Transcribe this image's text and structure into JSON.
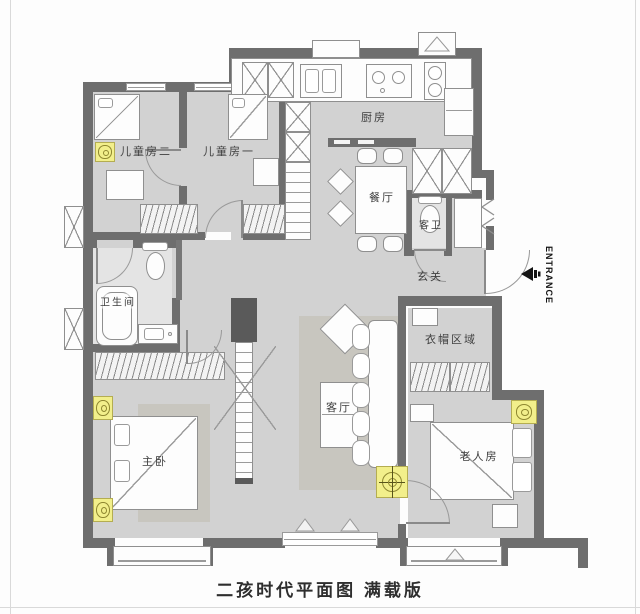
{
  "title": "二孩时代平面图 满载版",
  "entrance": {
    "label": "ENTRANCE"
  },
  "rooms": {
    "kids_room_2": {
      "label": "儿童房二"
    },
    "kids_room_1": {
      "label": "儿童房一"
    },
    "kitchen": {
      "label": "厨房"
    },
    "dining_room": {
      "label": "餐厅"
    },
    "guest_bathroom": {
      "label": "客卫"
    },
    "entry_hall": {
      "label": "玄关"
    },
    "bathroom": {
      "label": "卫生间"
    },
    "living_room": {
      "label": "客厅"
    },
    "cloakroom": {
      "label": "衣帽区域"
    },
    "master_bedroom": {
      "label": "主卧"
    },
    "elderly_room": {
      "label": "老人房"
    }
  },
  "colors": {
    "wall": "#6e6e6e",
    "floor": "#d2d2d2",
    "bathroom_floor": "#e4e4e4",
    "rug": "#c8c6bf",
    "highlight_yellow": "#f2ef8b",
    "outline": "#8f8f8f",
    "text": "#3e3e3e",
    "arrow": "#141414"
  }
}
